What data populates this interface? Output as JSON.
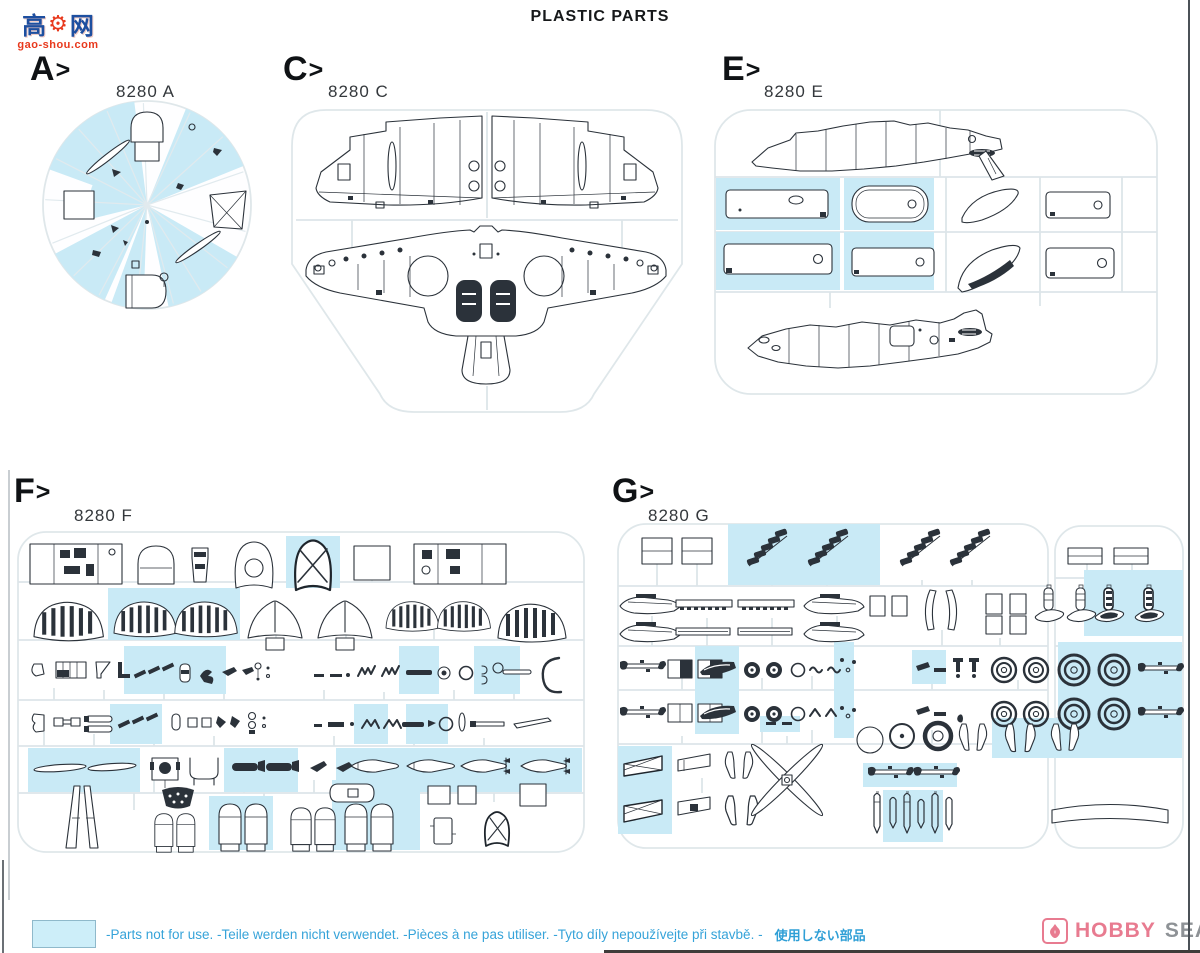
{
  "page_title": "PLASTIC PARTS",
  "watermark": {
    "cn_left": "高",
    "cn_right": "网",
    "gear_glyph": "⚙",
    "domain": "gao-shou.com"
  },
  "sections": {
    "a": {
      "header_letter": "A",
      "header_arrow": ">",
      "label": "8280 A"
    },
    "c": {
      "header_letter": "C",
      "header_arrow": ">",
      "label": "8280 C"
    },
    "e": {
      "header_letter": "E",
      "header_arrow": ">",
      "label": "8280 E"
    },
    "f": {
      "header_letter": "F",
      "header_arrow": ">",
      "label": "8280 F"
    },
    "g": {
      "header_letter": "G",
      "header_arrow": ">",
      "label": "8280 G"
    }
  },
  "legend": {
    "not_for_use_text": "-Parts not for use. -Teile werden nicht verwendet. -Pièces à ne pas utiliser. -Tyto díly nepoužívejte při stavbě. -",
    "not_for_use_text_jp": "使用しない部品"
  },
  "footer_logo": {
    "brand_primary": "HOBBY",
    "brand_secondary": "SEARCH",
    "flame_icon": "flame-icon"
  },
  "colors": {
    "highlight_blue": "#c9eaf6",
    "note_text_blue": "#36a3d9",
    "part_line": "#2b323a",
    "runner_gray": "#dde5e9",
    "logo_pink": "#e87b90",
    "logo_gray": "#8e9296",
    "watermark_blue": "#1d4fa0",
    "watermark_red": "#e8391d"
  }
}
